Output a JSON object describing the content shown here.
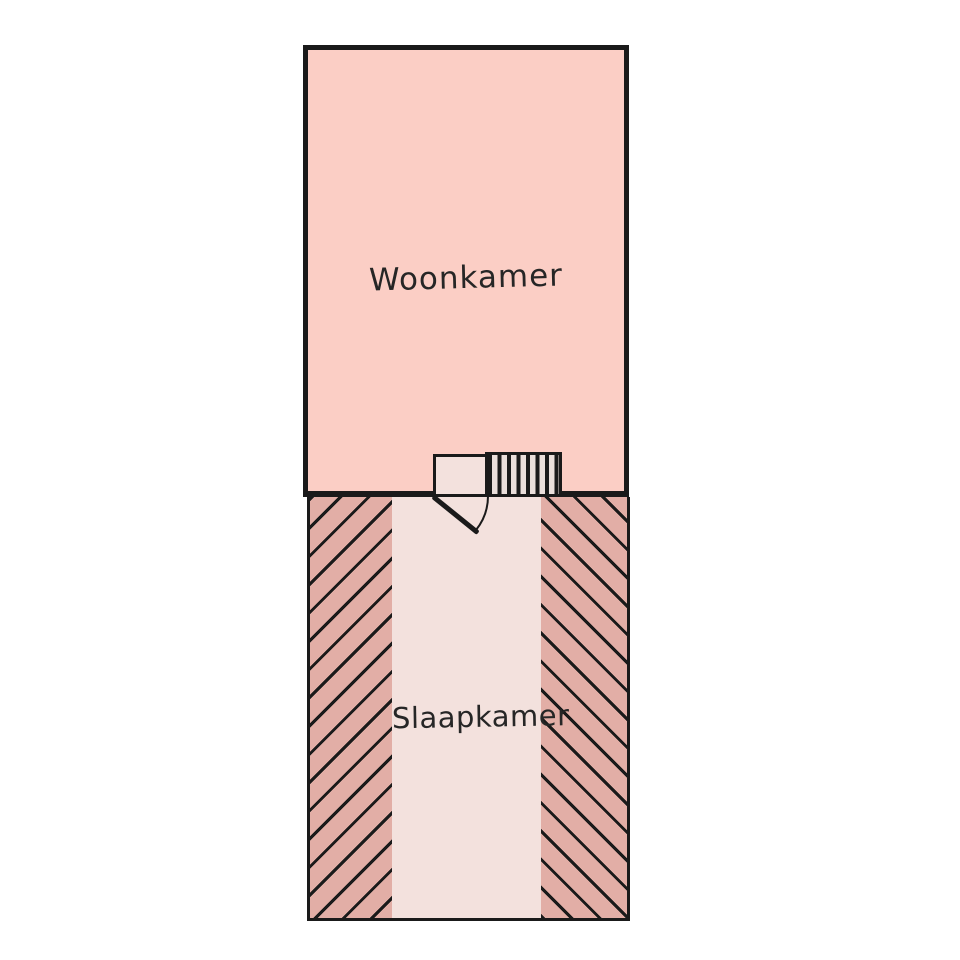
{
  "rooms": {
    "woonkamer": {
      "label": "Woonkamer",
      "fill": "#fbcec5"
    },
    "slaapkamer": {
      "label": "Slaapkamer",
      "floor_fill": "#f3e1dd",
      "hatched_wall_fill": "#e2aea6"
    }
  },
  "symbols": {
    "door": "door-swing",
    "radiator": "radiator-stripes"
  },
  "colors": {
    "background": "#ffffff",
    "wall_line": "#1a1a1a",
    "hatch_line": "#1a1a1a",
    "label_text": "#262626"
  }
}
